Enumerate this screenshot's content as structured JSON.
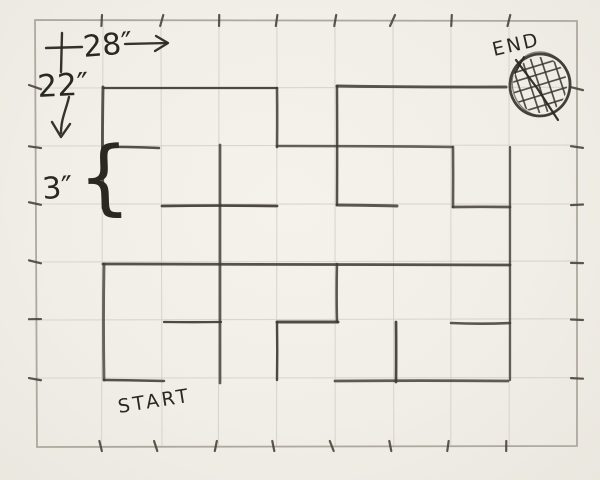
{
  "sketch": {
    "width_label": "28″",
    "height_label": "22″",
    "cell_size_label": "3″",
    "start_label": "START",
    "end_label": "END",
    "brace_glyph": "{"
  },
  "colors": {
    "paper": "#f2efe8",
    "pencil": "#3e3933",
    "ink_text": "#2b2723",
    "grid_faint": "#d6d1c8",
    "border_grey": "#aaa49a",
    "tick": "#4a443c"
  },
  "maze": {
    "border": [
      35,
      20,
      577,
      446
    ],
    "grid_cols": [
      103,
      161,
      219,
      277,
      335,
      393,
      451,
      509
    ],
    "grid_rows": [
      88,
      146,
      204,
      262,
      320,
      378
    ],
    "walls": [
      [
        103,
        88,
        277,
        88
      ],
      [
        337,
        86,
        506,
        87
      ],
      [
        103,
        147,
        159,
        148
      ],
      [
        277,
        146,
        452,
        147
      ],
      [
        162,
        206,
        277,
        206
      ],
      [
        337,
        205,
        397,
        206
      ],
      [
        453,
        207,
        510,
        207
      ],
      [
        103,
        264,
        510,
        265
      ],
      [
        164,
        322,
        221,
        322
      ],
      [
        277,
        322,
        338,
        322
      ],
      [
        451,
        323,
        510,
        323
      ],
      [
        104,
        380,
        164,
        381
      ],
      [
        335,
        381,
        508,
        381
      ],
      [
        103,
        87,
        103,
        208
      ],
      [
        104,
        264,
        104,
        380
      ],
      [
        277,
        88,
        277,
        147
      ],
      [
        220,
        145,
        220,
        383
      ],
      [
        337,
        86,
        337,
        205
      ],
      [
        453,
        147,
        453,
        207
      ],
      [
        510,
        147,
        510,
        380
      ],
      [
        337,
        264,
        337,
        322
      ],
      [
        277,
        322,
        277,
        380
      ],
      [
        396,
        322,
        396,
        382
      ]
    ],
    "end_marker": {
      "cx": 540,
      "cy": 85,
      "rx": 30,
      "ry": 31,
      "hatch_spacing": 10,
      "hatch_angle_a": 72,
      "hatch_angle_b": -17,
      "hatch_lines_per_set": 7
    }
  },
  "annotations": {
    "strokes": [
      {
        "name": "dimension-cross-vertical",
        "d": "M62,33 L61,72",
        "w": 2.4
      },
      {
        "name": "dimension-cross-horizontal",
        "d": "M46,48 L82,47",
        "w": 2.4
      },
      {
        "name": "width-arrow-shaft",
        "d": "M125,44 L167,43",
        "w": 2.3
      },
      {
        "name": "width-arrow-head",
        "d": "M156,36 L168,43 L155,51",
        "w": 2.3
      },
      {
        "name": "height-arrow-shaft",
        "d": "M69,97 C66,110 61,119 61,133",
        "w": 2.4
      },
      {
        "name": "height-arrow-head",
        "d": "M52,122 L61,137 L70,124",
        "w": 2.4
      },
      {
        "name": "end-marker-slash",
        "d": "M516,60 L537,88 L558,120",
        "w": 2.2
      },
      {
        "name": "end-marker-slash-short",
        "d": "M524,57 L515,73",
        "w": 2.0
      }
    ]
  }
}
